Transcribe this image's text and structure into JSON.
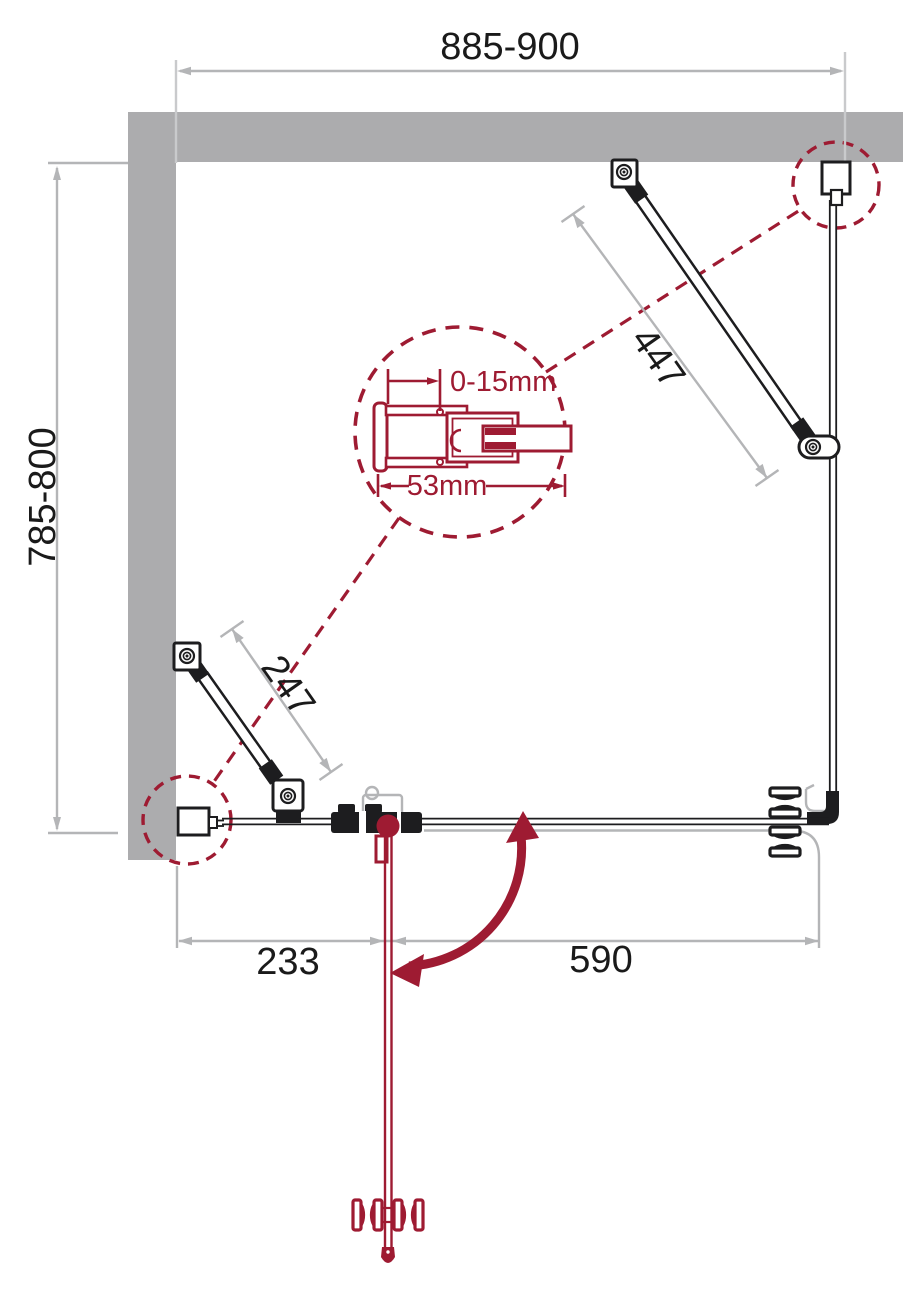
{
  "labels": {
    "width_total": "885-900",
    "depth_total": "785-800",
    "support_bar_long": "447",
    "support_bar_short": "247",
    "fixed_panel_width": "233",
    "door_width": "590",
    "wall_gap_adjustment": "0-15mm",
    "profile_width": "53mm"
  },
  "colors": {
    "accent_red": "#9E1B32",
    "wall_gray": "#ACACAE",
    "dim_gray": "#B4B5B7",
    "line_black": "#1D1D1F"
  }
}
